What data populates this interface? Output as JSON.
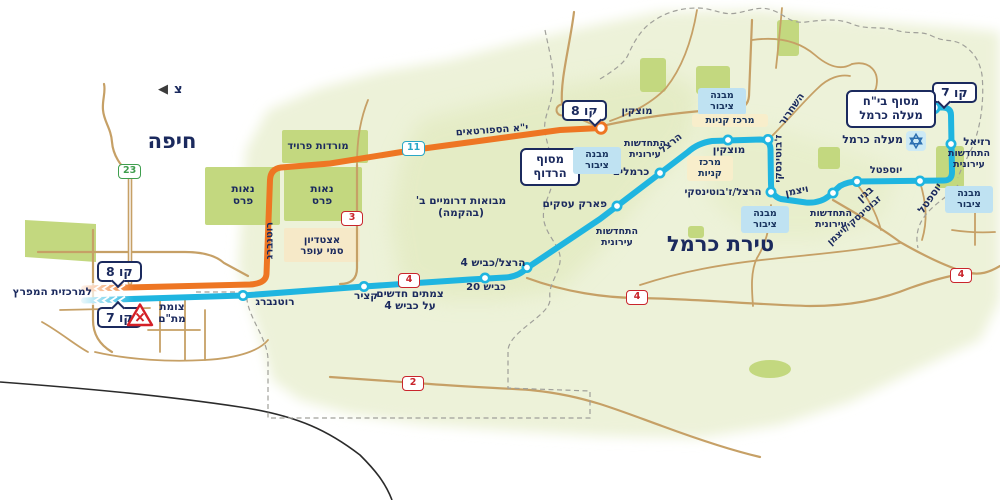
{
  "north_label": "צ",
  "cities": {
    "haifa": "חיפה",
    "tirat_carmel": "טירת כרמל"
  },
  "destinations": {
    "hamifratz": "למרכזית המפרץ"
  },
  "line_badges": {
    "line7": "קו 7",
    "line8": "קו 8"
  },
  "terminals": {
    "maale_carmel_hospital": "מסוף בי\"ח\nמעלה כרמל",
    "hardof": "מסוף\nהרדוף"
  },
  "stops": {
    "rotenberg": "רוטנברג",
    "katzir": "קציר",
    "herzl_kvish4": "הרצל/כביש 4",
    "park_asakim": "פארק עסקים",
    "carmelim": "כרמלים",
    "motzkin": "מוצקין",
    "herzl_jabotinsky": "הרצל/ז'בוטינסקי",
    "jabotinsky_weizmann": "זבוטינסקי/ויצמן",
    "begin": "בגין",
    "yoseftal": "יוספטל",
    "raziel": "רזיאל"
  },
  "streets": {
    "sportaim": "י\"א הספורטאים",
    "motzkin": "מוצקין",
    "hashichrur": "השחרור",
    "jabotinsky": "ז'בוטינסקי",
    "weizmann": "ויצמן",
    "herzl": "הרצל",
    "yoseftal": "יוספטל",
    "kvish_20": "כביש 20",
    "rotenberg": "רוטנברג"
  },
  "areas": {
    "mordot_freud": "מורדות פרויד",
    "neot_peres": "נאות\nפרס",
    "stadium": "אצטדיון\nסמי עופר",
    "mevoot_dromiim": "מבואות דרומיים ב'\n(בהקמה)",
    "urban_renewal": "התחדשות\nעירונית",
    "public_building": "מבנה\nציבור",
    "shopping_center": "מרכז קניות",
    "shopping_center_2l": "מרכז\nקניות",
    "maale_carmel": "מעלה כרמל"
  },
  "notes": {
    "tzomet_matam": "צומת\nמת\"ם",
    "new_junctions": "צמתים חדשים\nעל כביש 4"
  },
  "road_numbers": {
    "road2": "2",
    "road3": "3",
    "road4": "4",
    "road11": "11",
    "road23": "23"
  },
  "colors": {
    "line7_blue": "#1fb5e0",
    "line8_orange": "#ee7623",
    "navy_text": "#1b2a5e",
    "road_red": "#c9252c",
    "road_green": "#3f9e4e",
    "road_teal": "#2aa7c7",
    "road_tan": "#c6a066",
    "park_green": "#c3d87f"
  }
}
